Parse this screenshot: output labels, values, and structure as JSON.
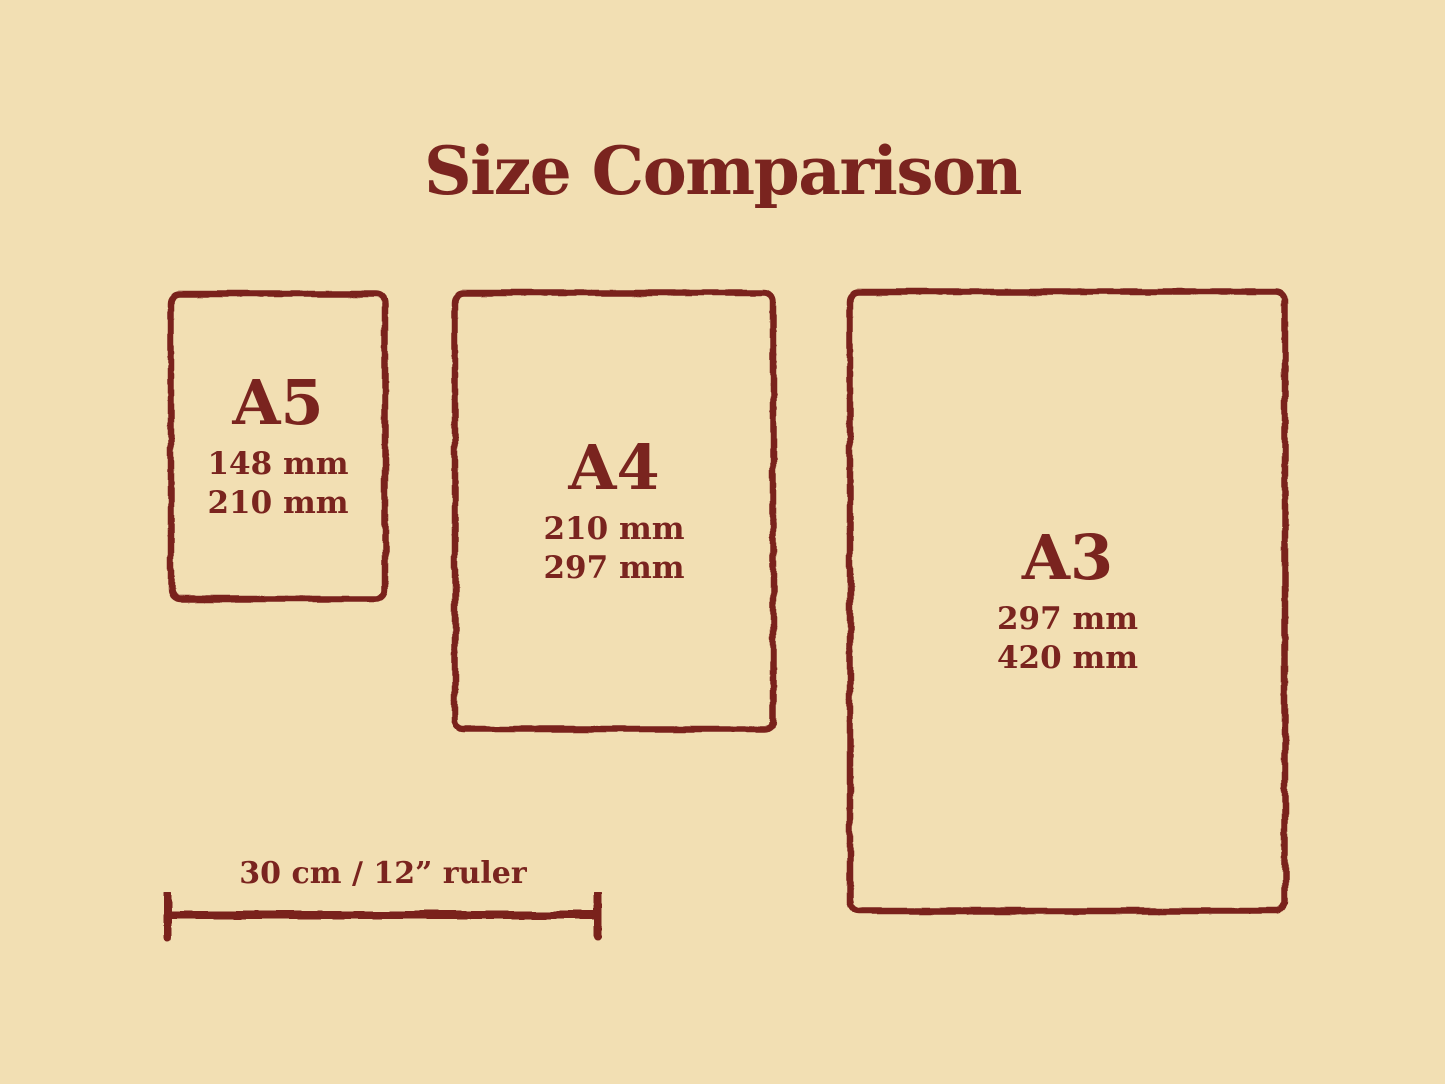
{
  "title": "Size Comparison",
  "colors": {
    "background": "#F2DFB3",
    "accent": "#7A241F"
  },
  "papers": [
    {
      "name": "A5",
      "width": "148 mm",
      "height": "210 mm"
    },
    {
      "name": "A4",
      "width": "210 mm",
      "height": "297 mm"
    },
    {
      "name": "A3",
      "width": "297 mm",
      "height": "420 mm"
    }
  ],
  "ruler": {
    "label": "30 cm / 12” ruler"
  }
}
